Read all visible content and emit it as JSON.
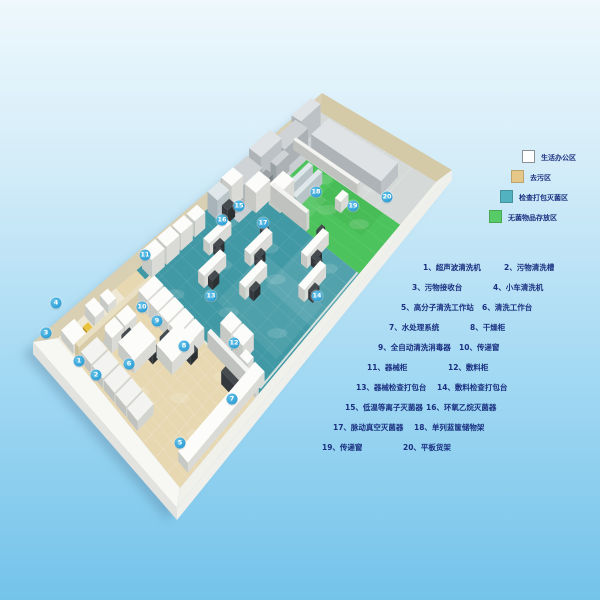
{
  "legend": {
    "items": [
      {
        "label": "生活办公区",
        "color": "#ffffff"
      },
      {
        "label": "去污区",
        "color": "#e5c888"
      },
      {
        "label": "检查打包灭菌区",
        "color": "#52b2c0"
      },
      {
        "label": "无菌物品存放区",
        "color": "#57cc66"
      }
    ]
  },
  "equipment_list": {
    "rows": [
      {
        "c1": "1、超声波清洗机",
        "c2": "2、污物清洗槽"
      },
      {
        "c1": "3、污物接收台",
        "c2": "4、小车清洗机"
      },
      {
        "c1": "5、高分子清洗工作站",
        "c2": "6、清洗工作台"
      },
      {
        "c1": "7、水处理系统",
        "c2": "8、干燥柜"
      },
      {
        "c1": "9、全自动清洗消毒器",
        "c2": "10、传递窗"
      },
      {
        "c1": "11、器械柜",
        "c2": "12、敷料柜"
      },
      {
        "c1": "13、器械检查打包台",
        "c2": "14、敷料检查打包台"
      },
      {
        "c1": "15、低温等离子灭菌器",
        "c2": "16、环氧乙烷灭菌器"
      },
      {
        "c1": "17、脉动真空灭菌器",
        "c2": "18、单列蓝筐储物架"
      },
      {
        "c1": "19、传递窗",
        "c2": "20、平板货架"
      }
    ]
  },
  "plan": {
    "zone_colors": {
      "office": "#efe8d4",
      "decontamination": "#e7d8b2",
      "inspection_sterilization": "#4199a5",
      "sterile_storage": "#4cc35c",
      "equipment_area": "#d5dad8"
    },
    "markers": [
      {
        "n": "1",
        "x": 79,
        "y": 361
      },
      {
        "n": "2",
        "x": 96,
        "y": 375
      },
      {
        "n": "3",
        "x": 46,
        "y": 333
      },
      {
        "n": "4",
        "x": 56,
        "y": 303
      },
      {
        "n": "5",
        "x": 180,
        "y": 443
      },
      {
        "n": "6",
        "x": 129,
        "y": 364
      },
      {
        "n": "7",
        "x": 232,
        "y": 399
      },
      {
        "n": "8",
        "x": 184,
        "y": 346
      },
      {
        "n": "9",
        "x": 157,
        "y": 321
      },
      {
        "n": "10",
        "x": 142,
        "y": 307
      },
      {
        "n": "11",
        "x": 145,
        "y": 255
      },
      {
        "n": "12",
        "x": 234,
        "y": 343
      },
      {
        "n": "13",
        "x": 211,
        "y": 296
      },
      {
        "n": "14",
        "x": 317,
        "y": 296
      },
      {
        "n": "15",
        "x": 239,
        "y": 206
      },
      {
        "n": "16",
        "x": 222,
        "y": 220
      },
      {
        "n": "17",
        "x": 263,
        "y": 223
      },
      {
        "n": "18",
        "x": 316,
        "y": 192
      },
      {
        "n": "19",
        "x": 353,
        "y": 206
      },
      {
        "n": "20",
        "x": 387,
        "y": 197
      }
    ]
  }
}
